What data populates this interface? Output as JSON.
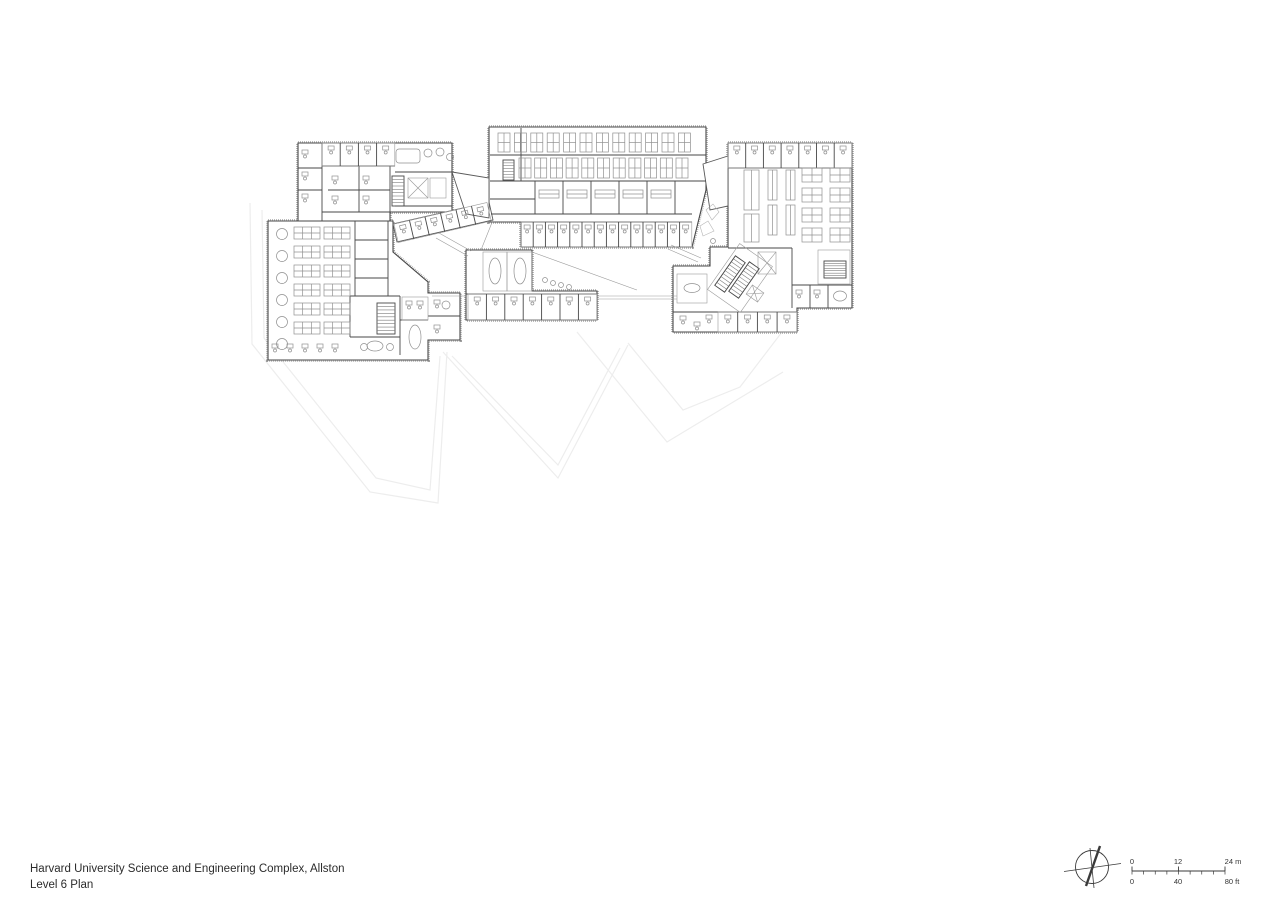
{
  "sheet": {
    "width": 1280,
    "height": 904,
    "background": "#ffffff"
  },
  "title_block": {
    "line1": "Harvard University Science and Engineering Complex, Allston",
    "line2": "Level 6 Plan"
  },
  "north_arrow": {
    "cx": 1092,
    "cy": 867,
    "r": 16.5,
    "cross_lines": [
      [
        1064,
        871.5,
        1121,
        863.5
      ],
      [
        1090,
        848,
        1094,
        888
      ]
    ],
    "needle": [
      1086,
      886,
      1100,
      846
    ]
  },
  "scale_bar": {
    "x0": 1132,
    "x1": 1225,
    "y": 871,
    "top_labels": [
      {
        "text": "0",
        "x": 1132
      },
      {
        "text": "12",
        "x": 1178
      },
      {
        "text": "24 m",
        "x": 1233
      }
    ],
    "bottom_labels": [
      {
        "text": "0",
        "x": 1132
      },
      {
        "text": "40",
        "x": 1178
      },
      {
        "text": "80 ft",
        "x": 1232
      }
    ]
  },
  "plan": {
    "colors": {
      "wall": "#474747",
      "furniture": "#909090",
      "boundary": "#a0a0a0",
      "site": "#ededed",
      "thin": "#9b9b9b"
    },
    "site_lines": [
      [
        [
          250,
          203
        ],
        [
          252,
          344
        ],
        [
          370,
          492
        ],
        [
          438,
          503
        ],
        [
          447,
          352
        ]
      ],
      [
        [
          262,
          210
        ],
        [
          264,
          338
        ],
        [
          376,
          478
        ],
        [
          430,
          490
        ],
        [
          440,
          356
        ]
      ],
      [
        [
          443,
          352
        ],
        [
          558,
          478
        ],
        [
          628,
          345
        ]
      ],
      [
        [
          452,
          356
        ],
        [
          558,
          465
        ],
        [
          620,
          348
        ]
      ],
      [
        [
          577,
          332
        ],
        [
          667,
          442
        ],
        [
          783,
          372
        ]
      ],
      [
        [
          628,
          343
        ],
        [
          683,
          410
        ],
        [
          740,
          387
        ],
        [
          782,
          332
        ]
      ]
    ],
    "wings": [
      [
        [
          298,
          143
        ],
        [
          452,
          143
        ],
        [
          452,
          212
        ],
        [
          390,
          212
        ],
        [
          390,
          221
        ],
        [
          298,
          221
        ]
      ],
      [
        [
          268,
          221
        ],
        [
          393,
          221
        ],
        [
          393,
          252
        ],
        [
          428,
          282
        ],
        [
          428,
          293
        ],
        [
          460,
          293
        ],
        [
          460,
          340
        ],
        [
          428,
          340
        ],
        [
          428,
          360
        ],
        [
          268,
          360
        ]
      ],
      [
        [
          489,
          127
        ],
        [
          706,
          127
        ],
        [
          706,
          190
        ],
        [
          692,
          247
        ],
        [
          521,
          247
        ],
        [
          521,
          222
        ],
        [
          489,
          222
        ]
      ],
      [
        [
          466,
          250
        ],
        [
          532,
          250
        ],
        [
          532,
          291
        ],
        [
          597,
          291
        ],
        [
          597,
          320
        ],
        [
          466,
          320
        ]
      ],
      [
        [
          728,
          143
        ],
        [
          852,
          143
        ],
        [
          852,
          308
        ],
        [
          797,
          308
        ],
        [
          797,
          332
        ],
        [
          673,
          332
        ],
        [
          673,
          266
        ],
        [
          710,
          266
        ],
        [
          710,
          247
        ],
        [
          728,
          247
        ]
      ]
    ],
    "links": [
      [
        [
          393,
          224
        ],
        [
          489,
          202
        ],
        [
          493,
          220
        ],
        [
          397,
          242
        ]
      ],
      [
        [
          452,
          172
        ],
        [
          489,
          178
        ],
        [
          489,
          218
        ],
        [
          466,
          214
        ]
      ],
      [
        [
          703,
          164
        ],
        [
          728,
          156
        ],
        [
          728,
          206
        ],
        [
          710,
          210
        ]
      ]
    ],
    "walls": [
      [
        322,
        143,
        322,
        221
      ],
      [
        298,
        168,
        322,
        168
      ],
      [
        298,
        190,
        322,
        190
      ],
      [
        322,
        166,
        395,
        166
      ],
      [
        322,
        212,
        390,
        212
      ],
      [
        359,
        166,
        359,
        212
      ],
      [
        328,
        190,
        390,
        190
      ],
      [
        390,
        166,
        390,
        212
      ],
      [
        395,
        172,
        452,
        172
      ],
      [
        395,
        206,
        452,
        206
      ],
      [
        355,
        221,
        355,
        296
      ],
      [
        388,
        221,
        388,
        296
      ],
      [
        355,
        240,
        388,
        240
      ],
      [
        355,
        259,
        388,
        259
      ],
      [
        355,
        278,
        388,
        278
      ],
      [
        350,
        296,
        400,
        296
      ],
      [
        350,
        296,
        350,
        337
      ],
      [
        350,
        337,
        400,
        337
      ],
      [
        400,
        296,
        400,
        355
      ],
      [
        400,
        320,
        428,
        320
      ],
      [
        428,
        316,
        460,
        316
      ],
      [
        490,
        155,
        706,
        155
      ],
      [
        490,
        181,
        706,
        181
      ],
      [
        491,
        214,
        692,
        214
      ],
      [
        521,
        128,
        521,
        181
      ],
      [
        490,
        199,
        535,
        199
      ],
      [
        535,
        181,
        535,
        214
      ],
      [
        563,
        181,
        563,
        214
      ],
      [
        591,
        181,
        591,
        214
      ],
      [
        619,
        181,
        619,
        214
      ],
      [
        647,
        181,
        647,
        214
      ],
      [
        675,
        181,
        675,
        214
      ],
      [
        521,
        222,
        692,
        222
      ],
      [
        466,
        294,
        597,
        294
      ],
      [
        728,
        168,
        852,
        168
      ],
      [
        728,
        248,
        792,
        248
      ],
      [
        792,
        248,
        792,
        308
      ],
      [
        792,
        285,
        852,
        285
      ],
      [
        810,
        285,
        810,
        308
      ],
      [
        828,
        285,
        828,
        308
      ],
      [
        673,
        312,
        797,
        312
      ]
    ],
    "room_rows": [
      {
        "x": 322,
        "y": 143,
        "w": 18.2,
        "h": 23,
        "n": 4,
        "dx": 18.2
      },
      {
        "x": 521,
        "y": 222,
        "w": 12.2,
        "h": 25,
        "n": 14,
        "dx": 12.2
      },
      {
        "x": 468,
        "y": 294,
        "w": 18.4,
        "h": 26,
        "n": 7,
        "dx": 18.4
      },
      {
        "x": 728,
        "y": 143,
        "w": 17.7,
        "h": 25,
        "n": 7,
        "dx": 17.7
      },
      {
        "x": 718,
        "y": 312,
        "w": 19.7,
        "h": 20,
        "n": 4,
        "dx": 19.7
      },
      {
        "px": 394,
        "py": 224,
        "rot": -13,
        "x": 0,
        "y": 0,
        "w": 15.9,
        "h": 19,
        "n": 6,
        "dx": 15.9
      }
    ],
    "bench_rows": [
      {
        "x": 498,
        "y": 133,
        "w": 12,
        "h": 19,
        "n": 12,
        "dx": 16.4,
        "cross": true
      },
      {
        "x": 519,
        "y": 158,
        "w": 12,
        "h": 20,
        "n": 11,
        "dx": 15.7,
        "cross": true
      },
      {
        "x": 744,
        "y": 170,
        "w": 15,
        "h": 40,
        "n": 1,
        "dx": 0
      },
      {
        "x": 744,
        "y": 214,
        "w": 15,
        "h": 28,
        "n": 1,
        "dx": 0
      },
      {
        "x": 768,
        "y": 170,
        "w": 9,
        "h": 30,
        "n": 2,
        "dx": 18
      },
      {
        "x": 768,
        "y": 205,
        "w": 9,
        "h": 30,
        "n": 2,
        "dx": 18
      }
    ],
    "bench2_rows": [
      {
        "x": 539,
        "y": 190,
        "w": 20,
        "h": 8,
        "n": 5,
        "dx": 28
      }
    ],
    "clusters": [
      {
        "x": 294,
        "y": 227
      },
      {
        "x": 324,
        "y": 227
      },
      {
        "x": 294,
        "y": 246
      },
      {
        "x": 324,
        "y": 246
      },
      {
        "x": 294,
        "y": 265
      },
      {
        "x": 324,
        "y": 265
      },
      {
        "x": 294,
        "y": 284
      },
      {
        "x": 324,
        "y": 284
      },
      {
        "x": 294,
        "y": 303
      },
      {
        "x": 324,
        "y": 303
      },
      {
        "x": 294,
        "y": 322
      },
      {
        "x": 324,
        "y": 322
      }
    ],
    "cluster_size": {
      "w": 26,
      "h": 12
    },
    "pods": [
      {
        "x": 802,
        "y": 168
      },
      {
        "x": 830,
        "y": 168
      },
      {
        "x": 802,
        "y": 188
      },
      {
        "x": 830,
        "y": 188
      },
      {
        "x": 802,
        "y": 208
      },
      {
        "x": 830,
        "y": 208
      },
      {
        "x": 802,
        "y": 228
      },
      {
        "x": 830,
        "y": 228
      }
    ],
    "pod_size": {
      "w": 20,
      "h": 14
    },
    "round_tables": [
      {
        "cx": 282,
        "cy": 234
      },
      {
        "cx": 282,
        "cy": 256
      },
      {
        "cx": 282,
        "cy": 278
      },
      {
        "cx": 282,
        "cy": 300
      },
      {
        "cx": 282,
        "cy": 322
      },
      {
        "cx": 282,
        "cy": 344
      }
    ],
    "round_table_r": 5.5,
    "tables": [
      {
        "cx": 495,
        "cy": 271,
        "rx": 6,
        "ry": 13
      },
      {
        "cx": 520,
        "cy": 271,
        "rx": 6,
        "ry": 13
      },
      {
        "cx": 692,
        "cy": 288,
        "rx": 8,
        "ry": 4.5
      },
      {
        "cx": 840,
        "cy": 296,
        "rx": 6.5,
        "ry": 5
      },
      {
        "cx": 375,
        "cy": 346,
        "rx": 8,
        "ry": 5
      },
      {
        "cx": 415,
        "cy": 337,
        "rx": 6,
        "ry": 12
      }
    ],
    "rects": [
      {
        "x": 483,
        "y": 252,
        "w": 24,
        "h": 39
      },
      {
        "x": 507,
        "y": 252,
        "w": 25,
        "h": 39
      },
      {
        "x": 677,
        "y": 274,
        "w": 30,
        "h": 29
      },
      {
        "x": 818,
        "y": 250,
        "w": 32,
        "h": 34
      },
      {
        "x": 408,
        "y": 178,
        "w": 20,
        "h": 20,
        "cls": "elev"
      },
      {
        "x": 430,
        "y": 178,
        "w": 16,
        "h": 20
      },
      {
        "x": 758,
        "y": 252,
        "w": 18,
        "h": 22,
        "cls": "elev"
      },
      {
        "x": 720,
        "y": 250,
        "w": 40,
        "h": 56,
        "rot": 35
      },
      {
        "x": 748,
        "y": 288,
        "w": 14,
        "h": 11,
        "rot": 35,
        "cls": "elev"
      },
      {
        "x": 396,
        "y": 149,
        "w": 24,
        "h": 14,
        "cls": "tableR"
      },
      {
        "x": 402,
        "y": 297,
        "w": 26,
        "h": 23
      }
    ],
    "stairs": [
      {
        "x": 392,
        "y": 176,
        "w": 12,
        "h": 30,
        "n": 8
      },
      {
        "x": 377,
        "y": 303,
        "w": 18,
        "h": 31,
        "n": 8
      },
      {
        "x": 503,
        "y": 160,
        "w": 11,
        "h": 20,
        "n": 6
      },
      {
        "x": 724,
        "y": 256,
        "w": 12,
        "h": 36,
        "n": 9,
        "rot": 35
      },
      {
        "x": 738,
        "y": 262,
        "w": 12,
        "h": 36,
        "n": 9,
        "rot": 35
      },
      {
        "x": 824,
        "y": 261,
        "w": 22,
        "h": 17,
        "n": 6
      }
    ],
    "desks": [
      [
        302,
        150
      ],
      [
        302,
        172
      ],
      [
        302,
        194
      ],
      [
        332,
        176
      ],
      [
        363,
        176
      ],
      [
        332,
        196
      ],
      [
        363,
        196
      ],
      [
        680,
        316
      ],
      [
        694,
        322
      ],
      [
        706,
        315
      ],
      [
        434,
        300
      ],
      [
        434,
        325
      ],
      [
        406,
        301
      ],
      [
        417,
        301
      ],
      [
        796,
        290
      ],
      [
        814,
        290
      ],
      [
        272,
        344
      ],
      [
        287,
        344
      ],
      [
        302,
        344
      ],
      [
        317,
        344
      ],
      [
        332,
        344
      ]
    ],
    "circles": [
      [
        428,
        153,
        4
      ],
      [
        440,
        152,
        4
      ],
      [
        450,
        157,
        3.5
      ],
      [
        446,
        305,
        4
      ],
      [
        364,
        347,
        3.5
      ],
      [
        390,
        347,
        3.5
      ],
      [
        545,
        280,
        2.5
      ],
      [
        553,
        283,
        2.5
      ],
      [
        561,
        285,
        2.5
      ],
      [
        569,
        287,
        2.5
      ],
      [
        713,
        241,
        2.5
      ]
    ],
    "thin_lines": [
      [
        432,
        296,
        466,
        296
      ],
      [
        597,
        296,
        677,
        296
      ],
      [
        597,
        299,
        677,
        299
      ],
      [
        532,
        252,
        637,
        290
      ],
      [
        436,
        238,
        468,
        256
      ],
      [
        439,
        233,
        471,
        251
      ],
      [
        668,
        249,
        698,
        262
      ],
      [
        671,
        245,
        701,
        258
      ],
      [
        493,
        220,
        481,
        250
      ]
    ],
    "blobs": [
      [
        [
          706,
          210
        ],
        [
          713,
          204
        ],
        [
          719,
          212
        ],
        [
          712,
          220
        ]
      ],
      [
        [
          700,
          226
        ],
        [
          708,
          221
        ],
        [
          714,
          231
        ],
        [
          703,
          236
        ]
      ]
    ]
  }
}
